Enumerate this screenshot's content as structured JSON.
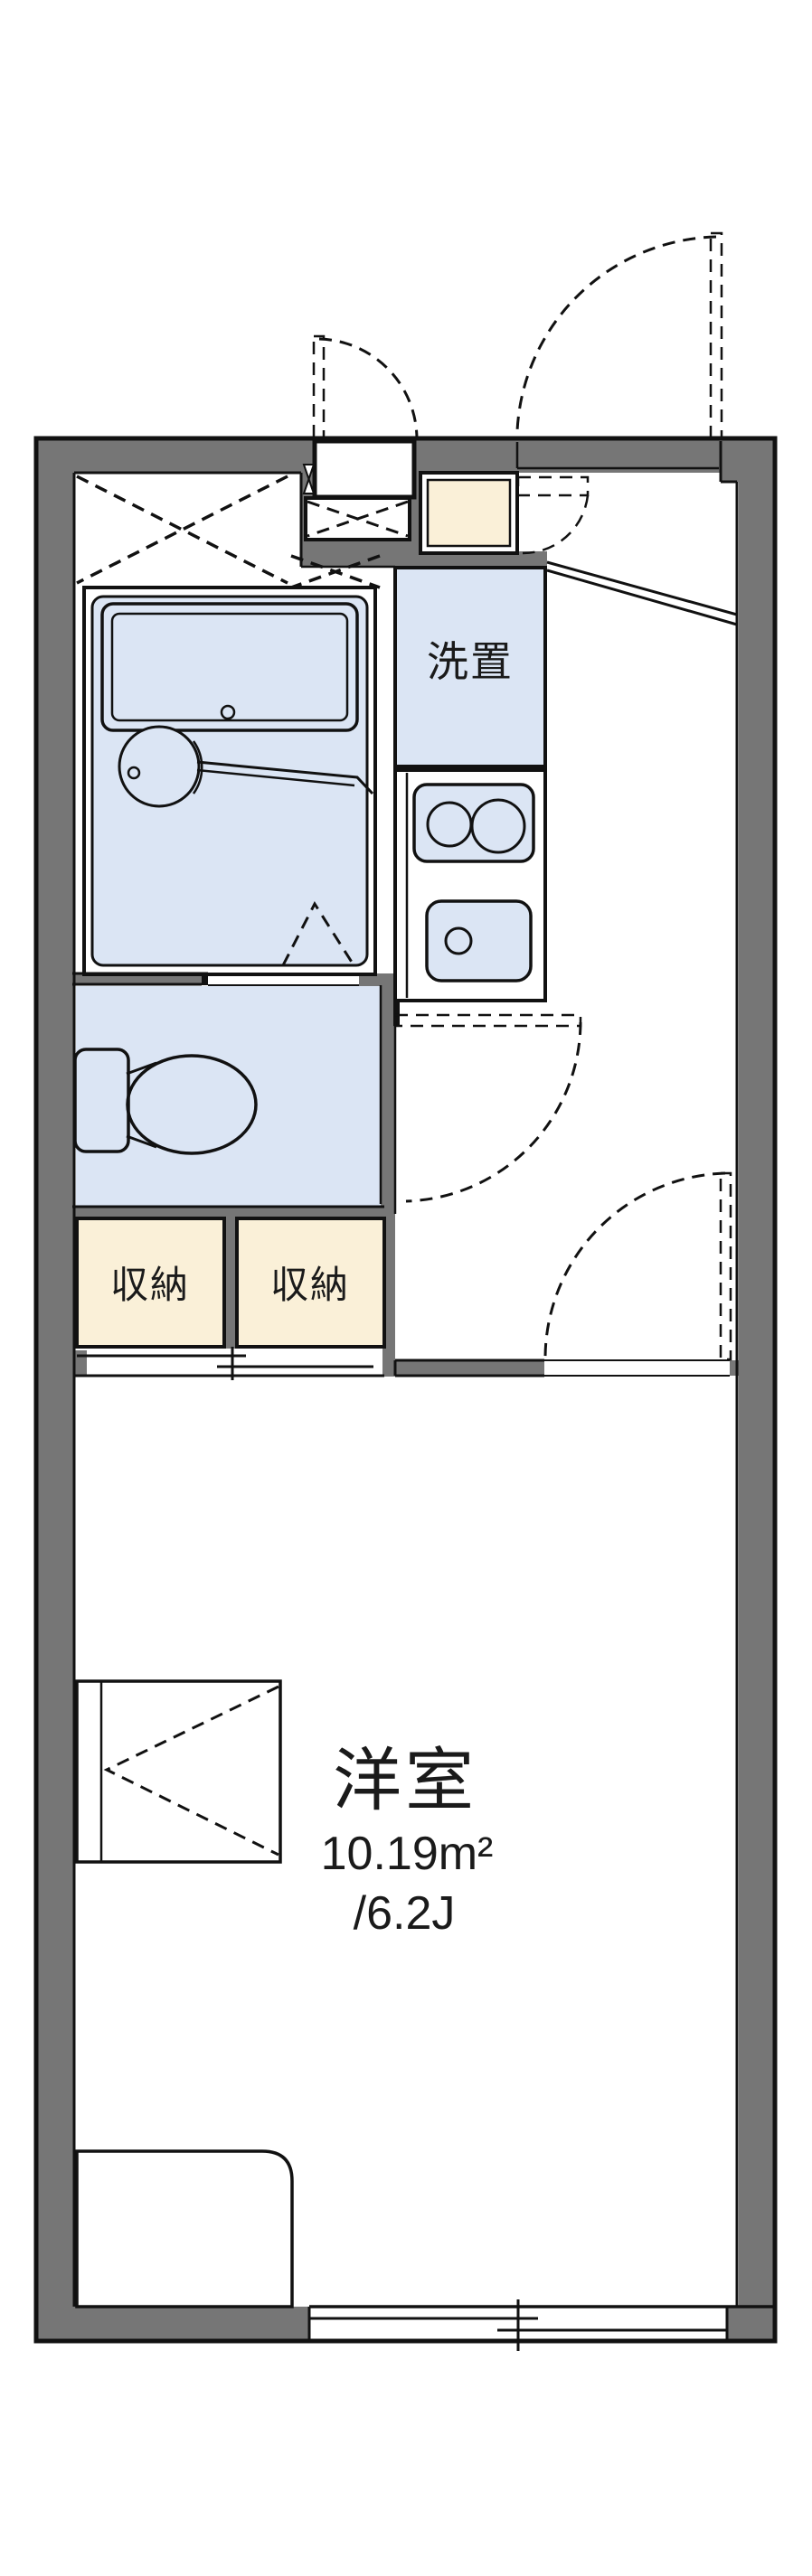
{
  "plan": {
    "type": "apartment-floor-plan",
    "rooms": {
      "washer": {
        "label": "洗置"
      },
      "storage_left": {
        "label": "収納"
      },
      "storage_right": {
        "label": "収納"
      },
      "main_room": {
        "label": "洋室",
        "area_m2": "10.19m²",
        "area_tatami": "/6.2J"
      }
    }
  },
  "colors": {
    "wall": "#767676",
    "fixture": "#dbe5f4",
    "storage": "#faf0d8",
    "line": "#111111",
    "text": "#1a1a1a",
    "background": "#ffffff"
  }
}
